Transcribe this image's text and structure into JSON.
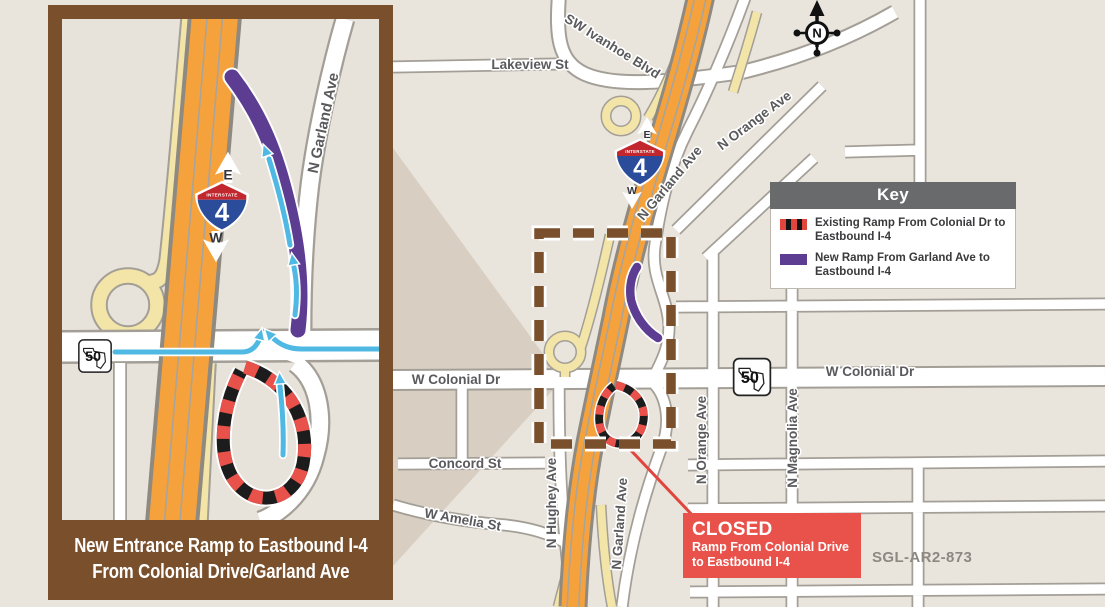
{
  "title_caption": {
    "line1": "New Entrance Ramp to Eastbound I-4",
    "line2": "From Colonial Drive/Garland Ave"
  },
  "key": {
    "title": "Key",
    "items": [
      {
        "swatch": "existing-ramp-red-black-dashed",
        "label": "Existing Ramp From Colonial Dr to Eastbound I-4"
      },
      {
        "swatch": "new-ramp-purple",
        "label": "New Ramp From Garland Ave to Eastbound I-4"
      }
    ]
  },
  "closed": {
    "title": "CLOSED",
    "line1": "Ramp From Colonial Drive",
    "line2": "to Eastbound I-4"
  },
  "compass_n": "N",
  "ref_code": "SGL-AR2-873",
  "shield": {
    "top": "INTERSTATE",
    "number": "4",
    "east": "E",
    "west": "W"
  },
  "route50": "50",
  "streets": {
    "lakeview": "Lakeview St",
    "ivanhoe": "SW Ivanhoe Blvd",
    "orange": "N Orange Ave",
    "garland": "N Garland Ave",
    "colonial": "W Colonial Dr",
    "concord": "Concord St",
    "amelia": "W Amelia St",
    "hughey": "N Hughey Ave",
    "magnolia": "N Magnolia Ave"
  },
  "colors": {
    "interstate_orange": "#f6a23c",
    "ramp_yellow": "#f3e5a8",
    "new_ramp_purple": "#5c3d91",
    "closed_red": "#e8524a",
    "flow_arrow_blue": "#4fb9e3",
    "frame_brown": "#7a4f2b",
    "key_header_gray": "#696a6c",
    "map_background": "#e9e4dc"
  }
}
